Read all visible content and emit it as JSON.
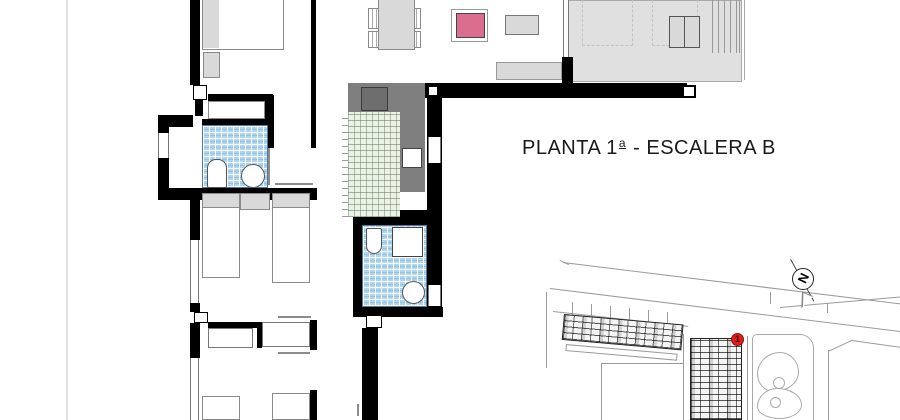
{
  "page": {
    "title": {
      "prefix": "PLANTA 1",
      "ordinal": "a",
      "suffix": " - ESCALERA B"
    }
  },
  "site_plan": {
    "marker_label": "1",
    "compass_symbol": "N"
  },
  "colors": {
    "wall_black": "#000000",
    "bathroom_tile_blue": "#aed6f0",
    "kitchen_tile_green": "#eaf2e5",
    "counter_gray": "#7f7f7f",
    "terrace_gray": "#e0e0e0",
    "furniture_gray": "#d9d9d9",
    "accent_pink_table": "#db6d8f",
    "marker_red": "#e61c1c",
    "siteplan_line_gray": "#9a9a9a"
  }
}
